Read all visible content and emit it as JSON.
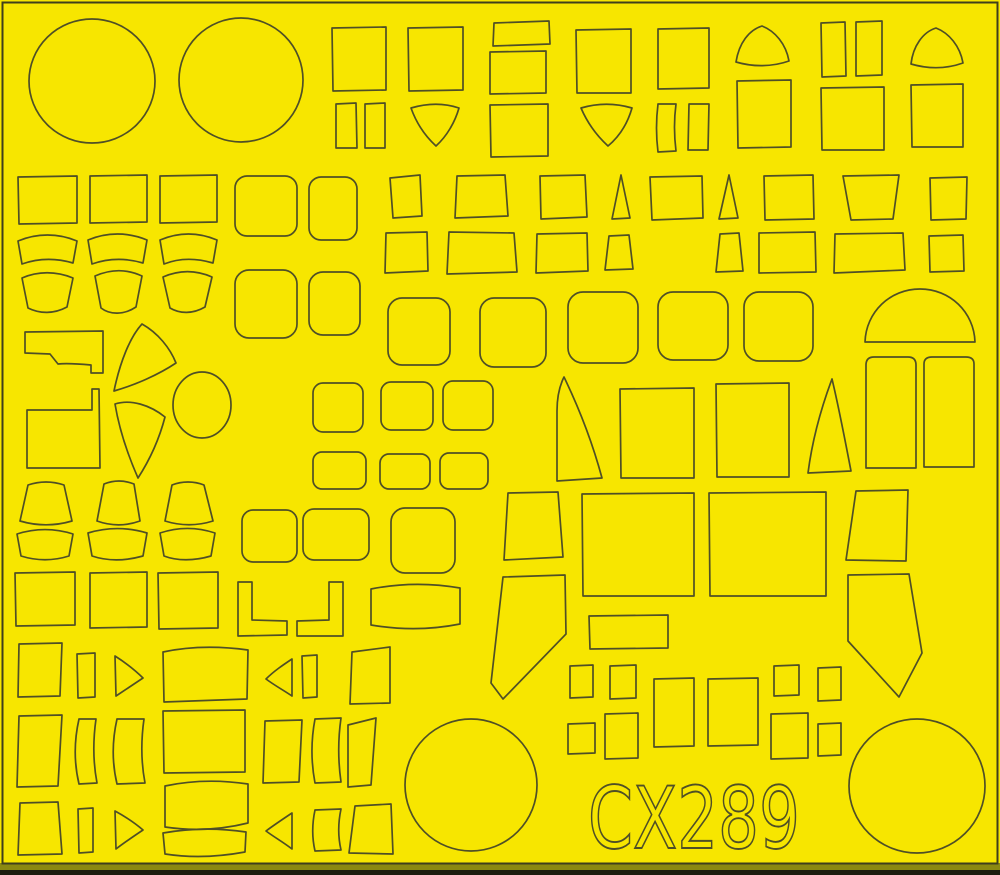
{
  "product_code": "CX289",
  "colors": {
    "sheet": "#f7e600",
    "line": "#4f4f26",
    "border": "#3f3f1c",
    "edge_olive": "#8b8911",
    "edge_dark": "#1c1c0e"
  },
  "code_label": {
    "value": "CX289",
    "x": 588,
    "y": 848,
    "font_size": 86,
    "text_length": 212
  },
  "shapes": [
    {
      "n": "circle-large-1",
      "e": [
        92,
        81,
        63,
        62
      ]
    },
    {
      "n": "circle-large-2",
      "e": [
        241,
        80,
        62,
        62
      ]
    },
    {
      "n": "square-1",
      "d": "M332,28 L386,27 L386,90 L333,91 Z"
    },
    {
      "n": "square-2",
      "d": "M408,28 L463,27 L463,90 L409,91 Z"
    },
    {
      "n": "rect-1",
      "d": "M494,23 L549,21 L550,44 L493,46 Z"
    },
    {
      "n": "rect-2",
      "d": "M490,52 L546,51 L546,93 L490,94 Z"
    },
    {
      "n": "rect-3",
      "d": "M490,105 L548,104 L548,156 L491,157 Z"
    },
    {
      "n": "square-3",
      "d": "M576,30 L631,29 L631,93 L577,93 Z"
    },
    {
      "n": "square-4",
      "d": "M658,29 L709,28 L709,88 L658,89 Z"
    },
    {
      "n": "dome-1",
      "d": "M736,62 C739,43 749,30 762,26 C775,31 786,44 789,61 C772,67 753,67 736,62 Z"
    },
    {
      "n": "square-5",
      "d": "M737,81 L791,80 L791,147 L738,148 Z"
    },
    {
      "n": "vrect-1",
      "d": "M821,23 L845,22 L846,76 L822,77 Z"
    },
    {
      "n": "vrect-2",
      "d": "M856,22 L882,21 L882,75 L856,76 Z"
    },
    {
      "n": "square-6",
      "d": "M821,88 L884,87 L884,150 L822,150 Z"
    },
    {
      "n": "dome-2",
      "d": "M911,64 C913,46 923,32 936,28 C949,33 960,46 963,63 C946,69 928,69 911,64 Z"
    },
    {
      "n": "square-7",
      "d": "M911,85 L963,84 L963,147 L912,147 Z"
    },
    {
      "n": "strip-1",
      "d": "M336,104 L356,103 L357,148 L336,148 Z"
    },
    {
      "n": "strip-2",
      "d": "M365,104 L385,103 L385,148 L365,148 Z"
    },
    {
      "n": "shield-1",
      "d": "M411,108 C428,103 444,103 459,108 C455,122 447,136 436,146 C424,135 416,122 411,108 Z"
    },
    {
      "n": "shield-2",
      "d": "M581,108 C598,103 615,103 632,108 C628,122 620,136 608,146 C596,135 587,122 581,108 Z"
    },
    {
      "n": "strip-3",
      "d": "M658,104 C656,120 656,136 658,152 L676,151 C674,135 674,119 676,104 Z"
    },
    {
      "n": "strip-4",
      "d": "M689,104 L709,104 L708,150 L688,150 Z"
    },
    {
      "n": "square-8",
      "d": "M18,177 L77,176 L77,223 L19,224 Z"
    },
    {
      "n": "square-9",
      "d": "M90,176 L147,175 L147,222 L90,223 Z"
    },
    {
      "n": "square-10",
      "d": "M160,176 L217,175 L217,222 L160,223 Z"
    },
    {
      "n": "arcband-1",
      "d": "M18,241 C37,233 58,233 77,241 L73,263 C56,258 39,258 22,264 Z"
    },
    {
      "n": "arcband-2",
      "d": "M88,240 C107,232 128,232 147,240 L143,263 C126,258 109,258 92,264 Z"
    },
    {
      "n": "arcband-3",
      "d": "M160,240 C179,232 198,232 217,240 L213,263 C196,258 179,258 164,264 Z"
    },
    {
      "n": "fanband-1",
      "d": "M22,278 C38,271 56,271 73,278 L67,307 C54,314 40,314 28,308 Z"
    },
    {
      "n": "fanband-2",
      "d": "M95,276 C111,269 127,269 142,276 L136,307 C124,315 110,315 101,308 Z"
    },
    {
      "n": "fanband-3",
      "d": "M163,277 C179,270 196,270 212,277 L205,307 C193,314 180,314 170,308 Z"
    },
    {
      "n": "rrect-1",
      "rr": [
        235,
        176,
        62,
        60,
        12
      ]
    },
    {
      "n": "rrect-2",
      "rr": [
        309,
        177,
        48,
        63,
        12
      ]
    },
    {
      "n": "rrect-3",
      "rr": [
        235,
        270,
        62,
        68,
        14
      ]
    },
    {
      "n": "rrect-4",
      "rr": [
        309,
        272,
        51,
        63,
        14
      ]
    },
    {
      "n": "quad-1",
      "d": "M390,178 L420,175 L422,216 L393,218 Z"
    },
    {
      "n": "quad-2",
      "d": "M457,176 L505,175 L508,216 L455,218 Z"
    },
    {
      "n": "quad-3",
      "d": "M540,176 L585,175 L587,217 L541,219 Z"
    },
    {
      "n": "wedge-1",
      "d": "M621,175 L630,218 L612,219 Z"
    },
    {
      "n": "quad-4",
      "d": "M650,177 L702,176 L703,218 L652,220 Z"
    },
    {
      "n": "wedge-2",
      "d": "M729,175 L738,218 L719,219 Z"
    },
    {
      "n": "quad-5",
      "d": "M764,176 L813,175 L814,219 L765,220 Z"
    },
    {
      "n": "quad-6",
      "d": "M843,176 L899,175 L893,219 L851,220 Z"
    },
    {
      "n": "quad-7",
      "d": "M930,178 L967,177 L966,219 L931,220 Z"
    },
    {
      "n": "quad-8",
      "d": "M386,233 L427,232 L428,271 L385,273 Z"
    },
    {
      "n": "quad-9",
      "d": "M449,232 L514,233 L517,272 L447,274 Z"
    },
    {
      "n": "quad-10",
      "d": "M537,234 L587,233 L588,271 L536,273 Z"
    },
    {
      "n": "keystone-1",
      "d": "M609,236 L629,235 L633,269 L605,270 Z"
    },
    {
      "n": "keystone-2",
      "d": "M720,234 L739,233 L743,271 L716,272 Z"
    },
    {
      "n": "rect-4",
      "d": "M759,233 L815,232 L816,272 L759,273 Z"
    },
    {
      "n": "quad-11",
      "d": "M835,234 L903,233 L905,270 L834,273 Z"
    },
    {
      "n": "quad-12",
      "d": "M929,236 L963,235 L964,271 L930,272 Z"
    },
    {
      "n": "dome-3",
      "d": "M865,342 C866,312 890,289 920,289 C950,289 974,312 975,342 Z"
    },
    {
      "n": "rrect-5",
      "rr": [
        388,
        298,
        62,
        67,
        14
      ]
    },
    {
      "n": "rrect-6",
      "rr": [
        480,
        298,
        66,
        69,
        14
      ]
    },
    {
      "n": "rrect-7",
      "rr": [
        568,
        292,
        70,
        71,
        15
      ]
    },
    {
      "n": "rrect-8",
      "rr": [
        658,
        292,
        70,
        68,
        15
      ]
    },
    {
      "n": "rrect-9",
      "rr": [
        744,
        292,
        69,
        69,
        15
      ]
    },
    {
      "n": "flag-1",
      "d": "M25,332 L103,331 L103,373 L91,373 L91,365 C80,364 68,363 58,364 L50,354 L25,353 Z"
    },
    {
      "n": "flag-2",
      "d": "M27,410 L92,410 L92,389 L99,389 L100,468 L27,468 Z"
    },
    {
      "n": "fan-sector-1",
      "d": "M142,324 C130,337 120,362 114,391 C135,385 158,375 176,363 C170,348 158,333 142,324 Z"
    },
    {
      "n": "fan-sector-2",
      "d": "M115,404 C131,399 150,405 165,417 C159,440 149,461 138,478 C127,453 119,428 115,404 Z"
    },
    {
      "n": "circle-small-1",
      "e": [
        202,
        405,
        29,
        33
      ]
    },
    {
      "n": "rrect-10",
      "rr": [
        313,
        383,
        50,
        49,
        10
      ]
    },
    {
      "n": "rrect-11",
      "rr": [
        381,
        382,
        52,
        48,
        10
      ]
    },
    {
      "n": "rrect-12",
      "rr": [
        443,
        381,
        50,
        49,
        10
      ]
    },
    {
      "n": "rrect-13",
      "rr": [
        313,
        452,
        53,
        37,
        9
      ]
    },
    {
      "n": "rrect-14",
      "rr": [
        380,
        454,
        50,
        35,
        9
      ]
    },
    {
      "n": "rrect-15",
      "rr": [
        440,
        453,
        48,
        36,
        9
      ]
    },
    {
      "n": "blade-1",
      "d": "M564,377 C559,387 557,398 557,411 L557,481 L602,478 C592,441 578,406 564,377 Z"
    },
    {
      "n": "square-11",
      "d": "M620,389 L694,388 L694,478 L621,478 Z"
    },
    {
      "n": "square-12",
      "d": "M716,384 L789,383 L789,477 L717,477 Z"
    },
    {
      "n": "spire-1",
      "d": "M832,379 C820,411 812,442 808,473 L851,471 C845,440 839,408 832,379 Z"
    },
    {
      "n": "tallrect-1",
      "d": "M866,468 L866,365 Q866,357 874,357 L908,357 Q916,357 916,365 L916,468 Z"
    },
    {
      "n": "tallrect-2",
      "d": "M924,467 L924,364 Q924,357 932,357 L966,357 Q974,357 974,364 L974,467 Z"
    },
    {
      "n": "bucket-1",
      "d": "M28,485 C40,481 52,481 64,485 L72,521 C55,526 37,526 20,521 Z"
    },
    {
      "n": "bucket-2",
      "d": "M104,484 C114,480 124,480 134,484 L140,521 C126,526 111,526 97,521 Z"
    },
    {
      "n": "bucket-3",
      "d": "M172,485 C182,481 194,481 204,485 L213,521 C197,526 181,526 165,521 Z"
    },
    {
      "n": "rrect-16",
      "rr": [
        242,
        510,
        55,
        52,
        11
      ]
    },
    {
      "n": "rrect-17",
      "rr": [
        303,
        509,
        66,
        51,
        11
      ]
    },
    {
      "n": "rrect-18",
      "rr": [
        391,
        508,
        64,
        65,
        14
      ]
    },
    {
      "n": "quad-13",
      "d": "M508,493 L558,492 L563,557 L504,560 Z"
    },
    {
      "n": "rect-large-1",
      "d": "M582,494 L694,493 L694,596 L583,596 Z"
    },
    {
      "n": "rect-large-2",
      "d": "M709,493 L826,492 L826,596 L710,596 Z"
    },
    {
      "n": "trapezoid-1",
      "d": "M856,491 L908,490 L906,561 L846,560 Z"
    },
    {
      "n": "boot-1",
      "d": "M848,575 L909,574 L922,653 L899,697 L848,641 Z"
    },
    {
      "n": "blade-2",
      "d": "M503,577 L565,575 L566,634 L503,699 L491,683 Z"
    },
    {
      "n": "l-bracket-1",
      "d": "M238,582 L252,582 L252,620 L287,621 L287,635 L238,636 Z"
    },
    {
      "n": "l-bracket-2",
      "d": "M329,582 L343,582 L343,636 L297,636 L297,621 L329,620 Z"
    },
    {
      "n": "band-1",
      "d": "M371,589 C401,583 431,583 460,588 L460,624 C430,630 400,630 371,625 Z"
    },
    {
      "n": "square-13",
      "d": "M15,573 L75,572 L75,625 L16,626 Z"
    },
    {
      "n": "square-14",
      "d": "M90,573 L147,572 L147,627 L90,628 Z"
    },
    {
      "n": "square-15",
      "d": "M158,573 L218,572 L218,628 L159,629 Z"
    },
    {
      "n": "arcband-4",
      "d": "M17,534 C36,528 54,528 73,534 L69,556 C53,561 37,561 21,556 Z"
    },
    {
      "n": "arcband-5",
      "d": "M88,533 C108,527 127,527 147,533 L143,556 C125,561 107,561 92,556 Z"
    },
    {
      "n": "arcband-6",
      "d": "M160,533 C178,527 197,527 215,533 L211,556 C194,561 177,561 164,556 Z"
    },
    {
      "n": "rect-5",
      "d": "M589,616 L668,615 L668,648 L590,649 Z"
    },
    {
      "n": "rect-6",
      "d": "M570,666 L593,665 L593,697 L570,698 Z"
    },
    {
      "n": "rect-7",
      "d": "M610,666 L636,665 L636,698 L610,699 Z"
    },
    {
      "n": "rect-8",
      "d": "M774,666 L799,665 L799,695 L774,696 Z"
    },
    {
      "n": "rect-9",
      "d": "M818,668 L841,667 L841,700 L818,701 Z"
    },
    {
      "n": "rect-10",
      "d": "M654,679 L694,678 L694,746 L654,747 Z"
    },
    {
      "n": "rect-11",
      "d": "M708,679 L758,678 L758,745 L708,746 Z"
    },
    {
      "n": "quad-14",
      "d": "M352,652 L390,647 L390,703 L350,704 Z"
    },
    {
      "n": "quad-15",
      "d": "M19,644 L62,643 L60,696 L18,697 Z"
    },
    {
      "n": "strip-5",
      "d": "M77,654 L95,653 L95,697 L78,698 Z"
    },
    {
      "n": "triangle-right-1",
      "d": "M115,656 C126,663 135,670 143,678 C134,684 125,690 116,696 Z"
    },
    {
      "n": "rect-wide-1",
      "d": "M163,652 C191,646 219,646 248,650 L247,699 L164,702 Z"
    },
    {
      "n": "triangle-left-1",
      "d": "M292,659 C283,665 274,671 266,679 C274,685 283,690 292,696 Z"
    },
    {
      "n": "strip-6",
      "d": "M302,656 L317,655 L317,697 L303,698 Z"
    },
    {
      "n": "quad-16",
      "d": "M19,716 L62,715 L58,786 L17,787 Z"
    },
    {
      "n": "bowstrip-1",
      "d": "M79,719 C74,741 74,763 79,784 L97,783 C93,762 93,740 96,719 Z"
    },
    {
      "n": "bowstrip-2",
      "d": "M117,719 C112,741 112,763 117,784 L145,783 C141,762 141,740 144,719 Z"
    },
    {
      "n": "square-16",
      "d": "M163,711 L245,710 L245,772 L164,773 Z"
    },
    {
      "n": "quad-17",
      "d": "M265,721 L302,720 L299,782 L263,783 Z"
    },
    {
      "n": "bowstrip-3",
      "d": "M315,719 C311,740 311,762 315,783 L341,782 C338,761 338,739 341,718 Z"
    },
    {
      "n": "quad-18",
      "d": "M348,725 L376,718 L371,785 L348,787 Z"
    },
    {
      "n": "quad-19",
      "d": "M355,806 L391,804 L393,854 L349,853 Z"
    },
    {
      "n": "circle-large-3",
      "e": [
        471,
        785,
        66,
        66
      ]
    },
    {
      "n": "band-2",
      "d": "M165,786 C193,780 221,780 248,784 L248,823 C220,830 192,831 165,827 Z"
    },
    {
      "n": "band-3",
      "d": "M163,833 C191,828 219,828 246,832 L245,852 C218,857 191,858 165,854 Z"
    },
    {
      "n": "quad-20",
      "d": "M20,803 L58,802 L62,854 L18,855 Z"
    },
    {
      "n": "strip-7",
      "d": "M78,809 L93,808 L93,852 L79,853 Z"
    },
    {
      "n": "triangle-right-2",
      "d": "M115,811 C126,817 135,823 143,830 C134,836 125,842 116,849 Z"
    },
    {
      "n": "triangle-left-2",
      "d": "M292,813 C283,819 274,825 266,831 C274,837 283,842 292,849 Z"
    },
    {
      "n": "bowstrip-4",
      "d": "M315,810 C312,824 312,838 315,851 L341,850 C338,837 338,823 341,809 Z"
    },
    {
      "n": "rect-12",
      "d": "M568,724 L595,723 L595,753 L568,754 Z"
    },
    {
      "n": "rect-13",
      "d": "M605,714 L638,713 L638,758 L605,759 Z"
    },
    {
      "n": "rect-14",
      "d": "M771,714 L808,713 L808,758 L771,759 Z"
    },
    {
      "n": "rect-15",
      "d": "M818,724 L841,723 L841,755 L818,756 Z"
    },
    {
      "n": "circle-large-4",
      "e": [
        917,
        786,
        68,
        67
      ]
    }
  ]
}
